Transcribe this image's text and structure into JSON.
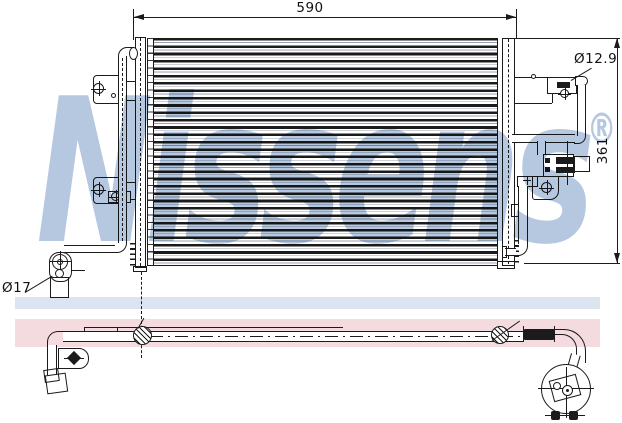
{
  "watermark": {
    "text": "Nissens",
    "registered": "®",
    "color": "#aec2dc"
  },
  "dimensions": {
    "overall_width": "590",
    "overall_height": "361",
    "pipe_diameter_top_right": "Ø12.9",
    "pipe_diameter_bottom_left": "Ø17"
  },
  "colors": {
    "line": "#1b1b1b",
    "band_blue": "#dbe5ef",
    "band_pink": "#f3dbe0"
  }
}
